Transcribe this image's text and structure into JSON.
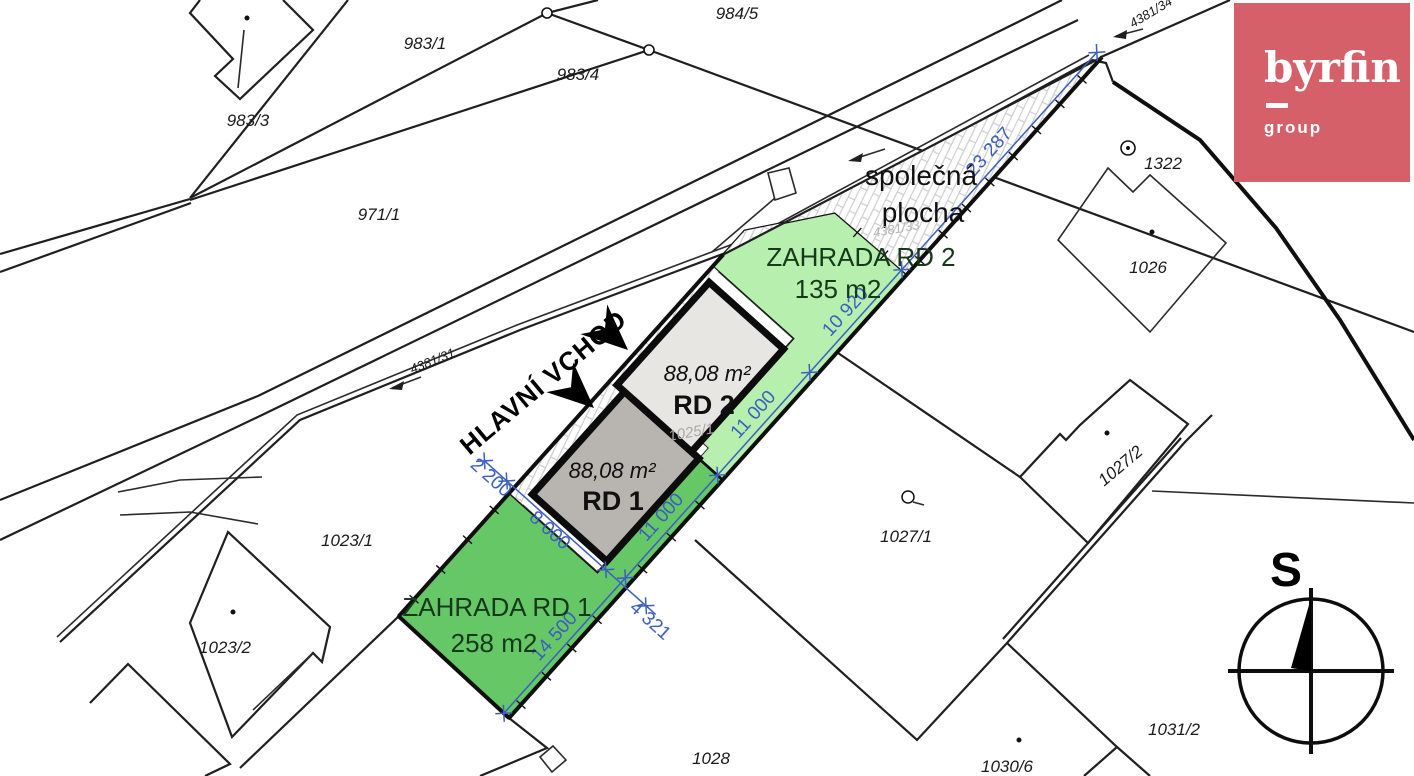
{
  "logo": {
    "brand": "byrfin",
    "sub": "group",
    "bg_color": "#d5606a"
  },
  "compass": {
    "north_label": "S"
  },
  "map": {
    "entrance_label": "HLAVNÍ VCHOD",
    "common_area": {
      "line1": "společná",
      "line2": "plocha",
      "parcel": "4381/33"
    },
    "buildings": [
      {
        "name": "RD 1",
        "area": "88,08 m²",
        "fill": "#b8b5b1",
        "parcel": "1025/1"
      },
      {
        "name": "RD 2",
        "area": "88,08 m²",
        "fill": "#e8e6e3"
      }
    ],
    "gardens": [
      {
        "name": "ZAHRADA RD 1",
        "area": "258 m2",
        "fill": "#66c767"
      },
      {
        "name": "ZAHRADA RD 2",
        "area": "135 m2",
        "fill": "#b7f0ae"
      }
    ],
    "dimensions": [
      "14 500",
      "11 000",
      "11 000",
      "10 920",
      "23 287",
      "2 200",
      "8 000",
      "4 321"
    ],
    "parcels": [
      "984/5",
      "983/1",
      "983/4",
      "983/3",
      "971/1",
      "4381/31",
      "4381/34",
      "1322",
      "1026",
      "1023/1",
      "1023/2",
      "1027/1",
      "1027/2",
      "1031/2",
      "1028",
      "1030/6"
    ],
    "colors": {
      "dimension_blue": "#3c5fc0",
      "garden_dark": "#66c767",
      "garden_light": "#b7f0ae"
    }
  }
}
